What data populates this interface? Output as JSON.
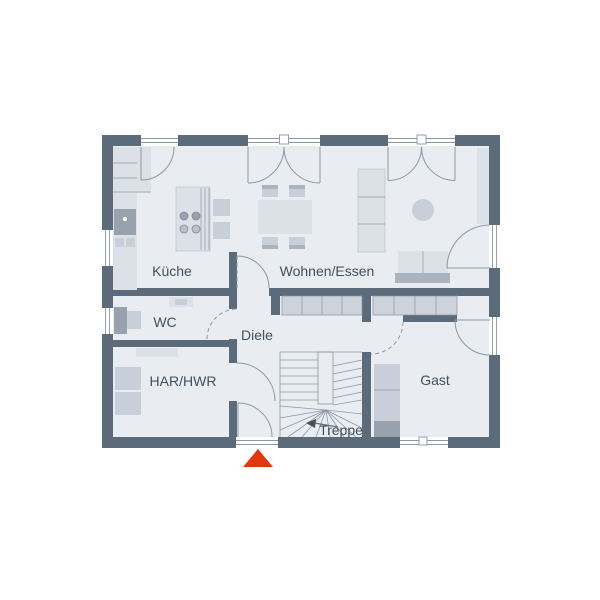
{
  "floorplan": {
    "rooms": [
      {
        "id": "kueche",
        "label": "Küche"
      },
      {
        "id": "wohnen-essen",
        "label": "Wohnen/Essen"
      },
      {
        "id": "wc",
        "label": "WC"
      },
      {
        "id": "diele",
        "label": "Diele"
      },
      {
        "id": "har-hwr",
        "label": "HAR/HWR"
      },
      {
        "id": "treppe",
        "label": "Treppe"
      },
      {
        "id": "gast",
        "label": "Gast"
      }
    ],
    "entrance_marker": {
      "shape": "triangle-up",
      "meaning": "entrance"
    },
    "colors": {
      "wall": "#5c6b7a",
      "floor": "#e9ecf1",
      "furniture_light": "#dce1e8",
      "furniture_medium": "#c8cfd8",
      "furniture_dark": "#aab4bf",
      "furniture_deep": "#97a2ae",
      "closet": "#ccd3db",
      "line": "#8b97a4",
      "window_line": "#8b97a4",
      "text": "#42505e",
      "marker": "#e0380f",
      "background": "#ffffff"
    }
  }
}
